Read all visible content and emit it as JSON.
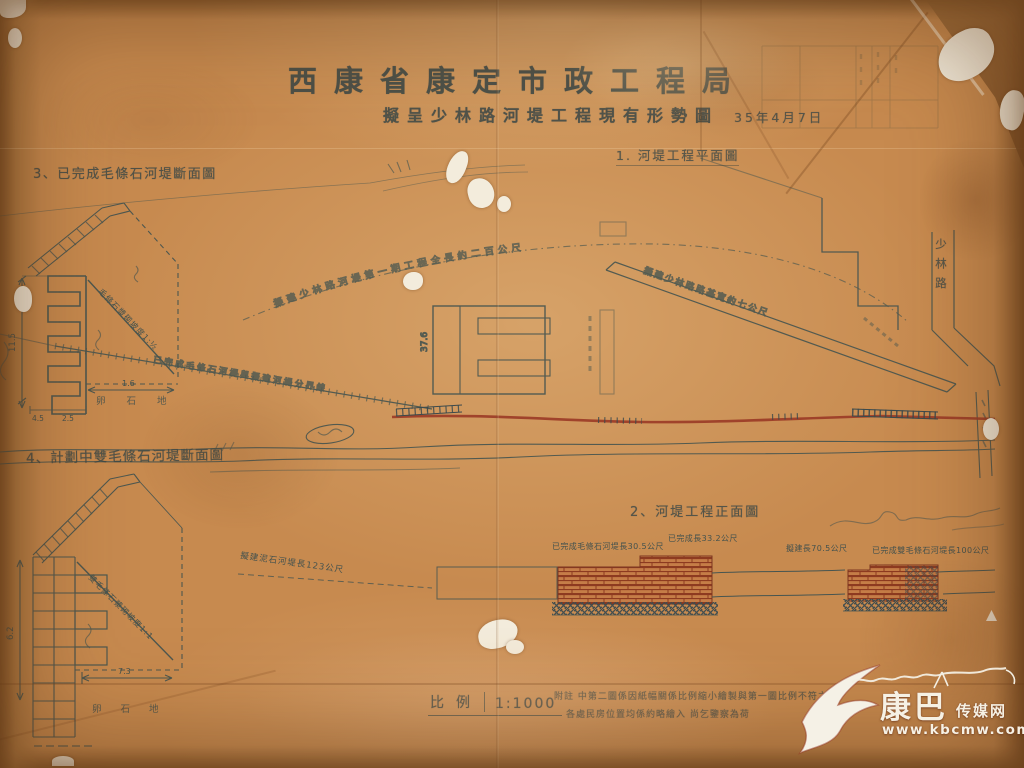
{
  "header": {
    "title": "西康省康定市政工程局",
    "subtitle": "擬呈少林路河堤工程現有形勢圖",
    "date": "35年4月7日"
  },
  "figures": {
    "fig1_label": "1. 河堤工程平面圖",
    "fig2_label": "2、河堤工程正面圖",
    "fig3_label": "3、已完成毛條石河堤斷面圖",
    "fig4_label": "4、計劃中雙毛條石河堤斷面圖"
  },
  "plan": {
    "road_vertical_label": "少林路",
    "building_dim": "37.6",
    "upper_curve_note": "擬建少林路河堤第一期工程全長約二百公尺",
    "lower_curve_note": "已完成毛條石河堤與擬建河堤分界線",
    "road_note": "擬建少林路路基寬約七公尺"
  },
  "sections": {
    "fig3": {
      "height": "11.5",
      "width": "1.6",
      "toe_a": "4.5",
      "toe_b": "2.5",
      "slope_note": "毛條石漿砌坡度1:½",
      "ground": "卵 石 地"
    },
    "fig4": {
      "height": "6.2",
      "width": "7.3",
      "slope_note": "雙毛條石漿砌坡度1:1",
      "ground": "卵 石 地"
    }
  },
  "elevation": {
    "ann_left": "擬建泥石河堤長123公尺",
    "ann_wall1": "已完成毛條石河堤長30.5公尺",
    "ann_wall2": "已完成長33.2公尺",
    "ann_gap": "擬建長70.5公尺",
    "ann_wall3": "已完成雙毛條石河堤長100公尺"
  },
  "footer": {
    "scale_label": "比例",
    "scale_value": "1:1000",
    "note_line1": "附註 中第二圖係因紙幅關係比例縮小繪製與第一圖比例不符之處",
    "note_line2": "各處民房位置均係約略繪入 尚乞鑒察為荷"
  },
  "watermark": {
    "brand_big": "康巴",
    "brand_small": "传媒网",
    "url": "www.kbcmw.com"
  }
}
